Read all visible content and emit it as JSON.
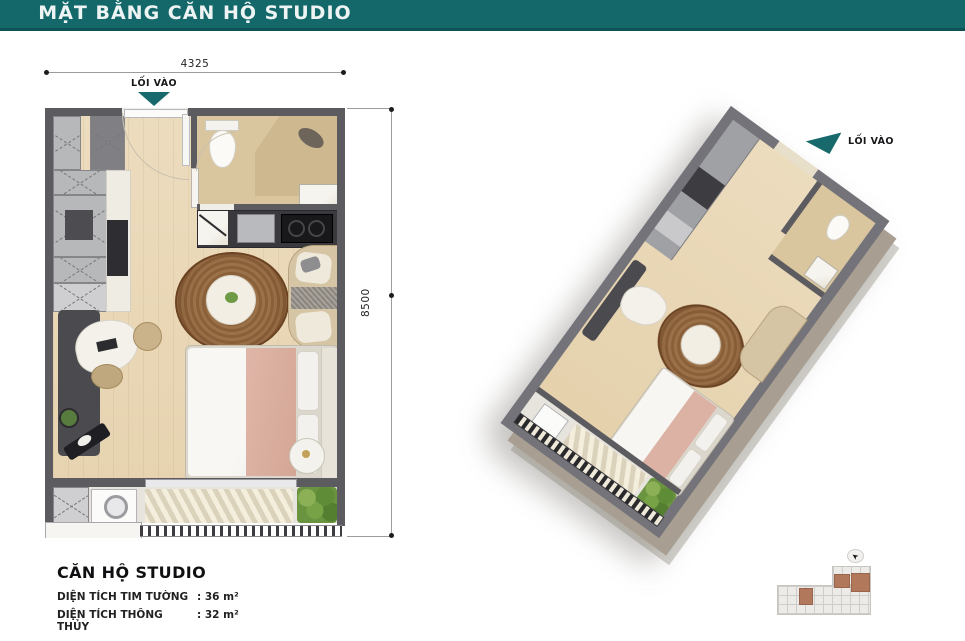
{
  "header": {
    "title": "MẶT BẰNG CĂN HỘ STUDIO"
  },
  "plan2d": {
    "entrance_label": "LỐI VÀO",
    "dim_width": "4325",
    "dim_height": "8500"
  },
  "plan3d": {
    "entrance_label": "LỐI VÀO"
  },
  "info": {
    "title": "CĂN HỘ STUDIO",
    "rows": [
      {
        "label": "DIỆN TÍCH TIM TƯỜNG",
        "value": ": 36 m²"
      },
      {
        "label": "DIỆN TÍCH THÔNG THỦY",
        "value": ": 32 m²"
      }
    ]
  },
  "colors": {
    "teal": "#14686a",
    "wall": "#5c5b60",
    "wood": "#e9d8b8",
    "bath": "#d9c69e",
    "rug_brown": "#8a5c36",
    "unit_highlight": "#b1785c"
  }
}
